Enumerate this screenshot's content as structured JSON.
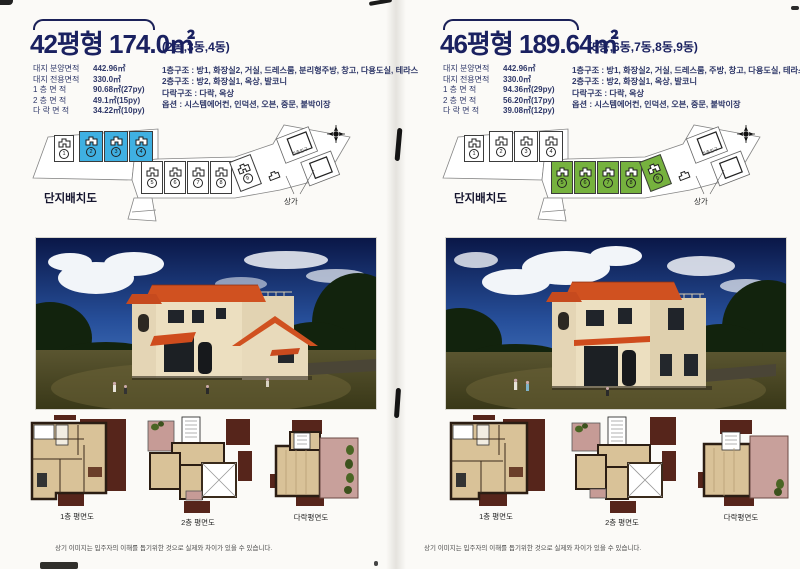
{
  "panels": [
    {
      "title": "42평형 174.0㎡",
      "subtitle": "(2동,3동,4동)",
      "accent": "#3fb0e2",
      "specs": [
        {
          "label": "대지 분양면적",
          "value": "442.96㎡"
        },
        {
          "label": "대지 전용면적",
          "value": "330.0㎡"
        },
        {
          "label": "1 층 면 적",
          "value": "90.68㎡(27py)"
        },
        {
          "label": "2 층 면 적",
          "value": "49.1㎡(15py)"
        },
        {
          "label": "다 락 면 적",
          "value": "34.22㎡(10py)"
        }
      ],
      "structures": [
        "1층구조 : 방1, 화장실2, 거실, 드레스룸, 분리형주방, 창고, 다용도실, 테라스",
        "2층구조 : 방2, 화장실1, 옥상, 발코니",
        "다락구조 : 다락, 옥상",
        "옵션 : 시스템에어컨, 인덕션, 오븐, 중문, 붙박이장"
      ],
      "site_plan": {
        "label": "단지배치도",
        "shop_label": "상가",
        "entrance_label": "주출입구",
        "lots": [
          {
            "n": "1",
            "hl": false
          },
          {
            "n": "2",
            "hl": true
          },
          {
            "n": "3",
            "hl": true
          },
          {
            "n": "4",
            "hl": true
          },
          {
            "n": "5",
            "hl": false
          },
          {
            "n": "6",
            "hl": false
          },
          {
            "n": "7",
            "hl": false
          },
          {
            "n": "8",
            "hl": false
          },
          {
            "n": "9",
            "hl": false
          }
        ]
      },
      "floor_plans": [
        {
          "label": "1층 평면도"
        },
        {
          "label": "2층 평면도"
        },
        {
          "label": "다락평면도"
        }
      ],
      "footnote": "상기 이미지는 입주자의 이해를 돕기위한 것으로 실제와 차이가 있을 수 있습니다."
    },
    {
      "title": "46평형 189.64㎡",
      "subtitle": "(5동,6동,7동,8동,9동)",
      "accent": "#76b23e",
      "specs": [
        {
          "label": "대지 분양면적",
          "value": "442.96㎡"
        },
        {
          "label": "대지 전용면적",
          "value": "330.0㎡"
        },
        {
          "label": "1 층 면 적",
          "value": "94.36㎡(29py)"
        },
        {
          "label": "2 층 면 적",
          "value": "56.20㎡(17py)"
        },
        {
          "label": "다 락 면 적",
          "value": "39.08㎡(12py)"
        }
      ],
      "structures": [
        "1층구조 : 방1, 화장실2, 거실, 드레스룸, 주방, 창고, 다용도실, 테라스",
        "2층구조 : 방2, 화장실1, 옥상, 발코니",
        "다락구조 : 다락, 옥상",
        "옵션 : 시스템에어컨, 인덕션, 오븐, 중문, 붙박이장"
      ],
      "site_plan": {
        "label": "단지배치도",
        "shop_label": "상가",
        "entrance_label": "주출입구",
        "lots": [
          {
            "n": "1",
            "hl": false
          },
          {
            "n": "2",
            "hl": false
          },
          {
            "n": "3",
            "hl": false
          },
          {
            "n": "4",
            "hl": false
          },
          {
            "n": "5",
            "hl": true
          },
          {
            "n": "6",
            "hl": true
          },
          {
            "n": "7",
            "hl": true
          },
          {
            "n": "8",
            "hl": true
          },
          {
            "n": "9",
            "hl": true
          }
        ]
      },
      "floor_plans": [
        {
          "label": "1층 평면도"
        },
        {
          "label": "2층 평면도"
        },
        {
          "label": "다락평면도"
        }
      ],
      "footnote": "상기 이미지는 입주자의 이해를 돕기위한 것으로 실제와 차이가 있을 수 있습니다."
    }
  ]
}
